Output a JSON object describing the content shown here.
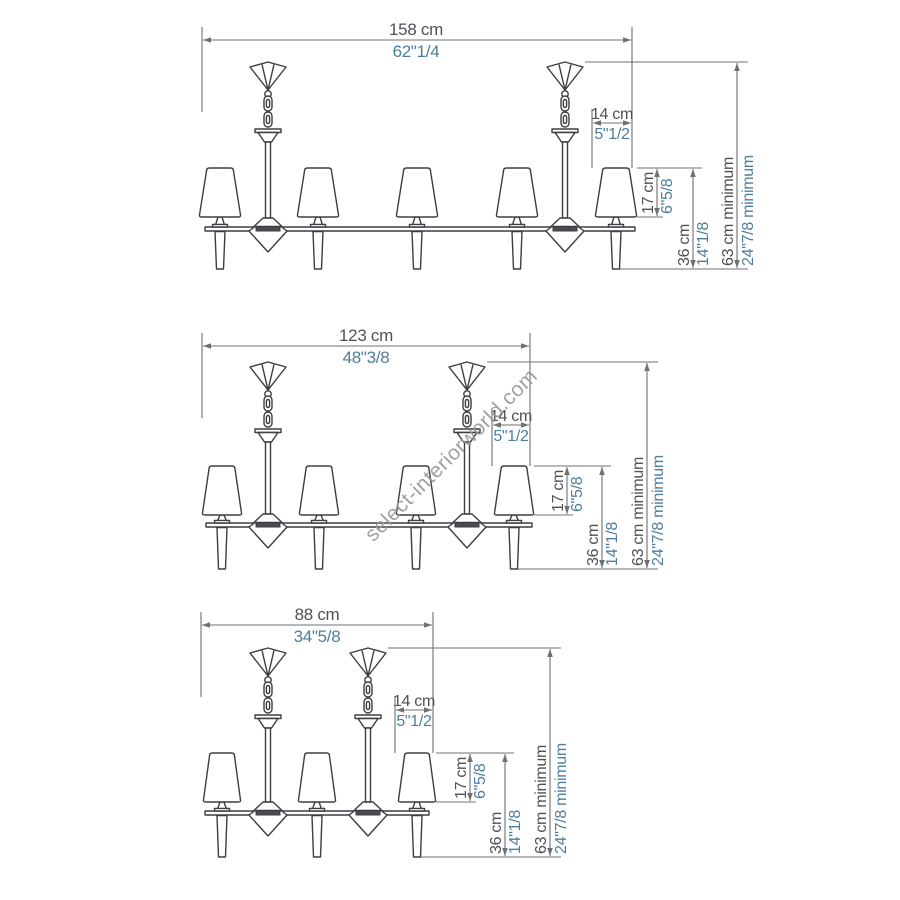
{
  "watermark": "select-interiorworld.com",
  "colors": {
    "line_art": "#3d3e42",
    "dimension_lines": "#6f7074",
    "cm_text": "#4f5156",
    "inch_text": "#4e7d9d",
    "watermark": "#969696",
    "background": "#ffffff"
  },
  "drawings": [
    {
      "id": "size-158",
      "lights": 5,
      "width": {
        "cm": "158 cm",
        "inch": "62\"1/4"
      },
      "canopy": {
        "cm": "14 cm",
        "inch": "5\"1/2"
      },
      "shade_height": {
        "cm": "17 cm",
        "inch": "6\"5/8"
      },
      "body_height": {
        "cm": "36 cm",
        "inch": "14\"1/8"
      },
      "min_height": {
        "cm": "63 cm minimum",
        "inch": "24\"7/8 minimum"
      }
    },
    {
      "id": "size-123",
      "lights": 4,
      "width": {
        "cm": "123 cm",
        "inch": "48\"3/8"
      },
      "canopy": {
        "cm": "14 cm",
        "inch": "5\"1/2"
      },
      "shade_height": {
        "cm": "17 cm",
        "inch": "6\"5/8"
      },
      "body_height": {
        "cm": "36 cm",
        "inch": "14\"1/8"
      },
      "min_height": {
        "cm": "63 cm minimum",
        "inch": "24\"7/8 minimum"
      }
    },
    {
      "id": "size-88",
      "lights": 3,
      "width": {
        "cm": "88 cm",
        "inch": "34\"5/8"
      },
      "canopy": {
        "cm": "14 cm",
        "inch": "5\"1/2"
      },
      "shade_height": {
        "cm": "17 cm",
        "inch": "6\"5/8"
      },
      "body_height": {
        "cm": "36 cm",
        "inch": "14\"1/8"
      },
      "min_height": {
        "cm": "63 cm minimum",
        "inch": "24\"7/8 minimum"
      }
    }
  ]
}
